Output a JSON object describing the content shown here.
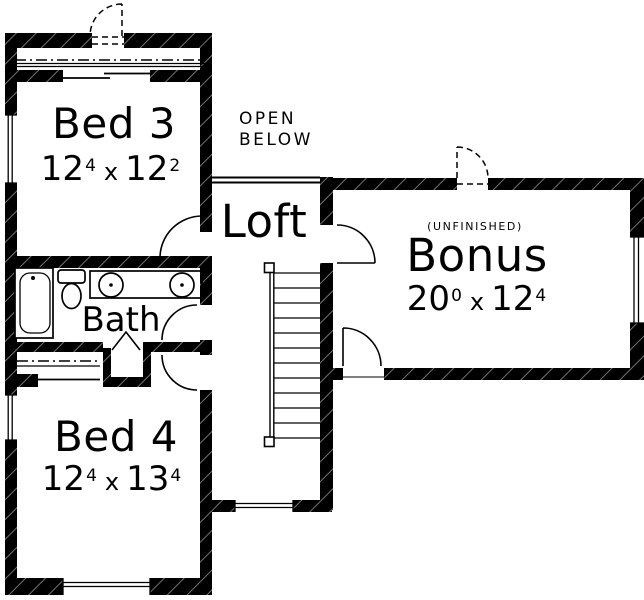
{
  "rooms": {
    "bed3": {
      "name": "Bed 3",
      "dim": {
        "w": "12",
        "w_sup": "4",
        "sep": "x",
        "h": "12",
        "h_sup": "2"
      }
    },
    "bed4": {
      "name": "Bed 4",
      "dim": {
        "w": "12",
        "w_sup": "4",
        "sep": "x",
        "h": "13",
        "h_sup": "4"
      }
    },
    "bath": {
      "name": "Bath"
    },
    "loft": {
      "name": "Loft"
    },
    "bonus": {
      "name": "Bonus",
      "tag": "(UNFINISHED)",
      "dim": {
        "w": "20",
        "w_sup": "0",
        "sep": "x",
        "h": "12",
        "h_sup": "4"
      }
    },
    "open_below": {
      "line1": "OPEN",
      "line2": "BELOW"
    }
  },
  "colors": {
    "wall": "#000000",
    "background": "#ffffff",
    "line": "#000000"
  }
}
